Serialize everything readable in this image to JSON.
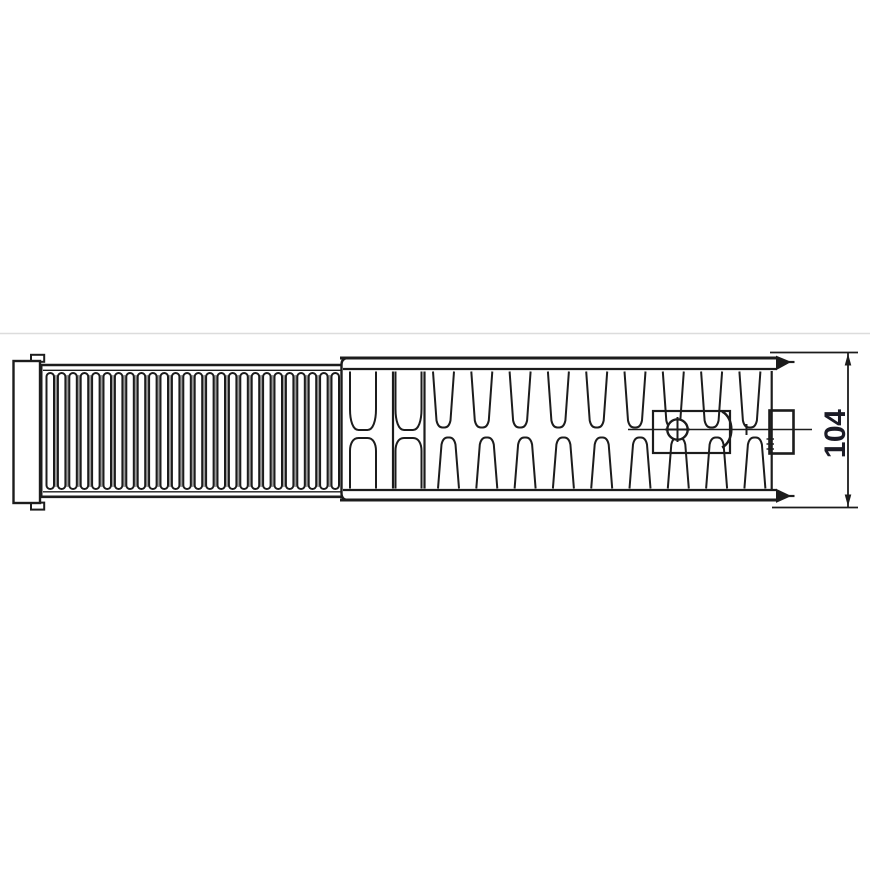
{
  "drawing": {
    "kind": "radiator-top-view-technical-drawing",
    "dimension": {
      "value": "104"
    },
    "grille": {
      "slot_count": 26,
      "shade_strip_count": 25
    },
    "convector": {
      "hourglass_fin_count": 2,
      "upper_fin_count": 9,
      "lower_fin_count": 9
    },
    "icons": {
      "valve": "circle-cross-valve-icon",
      "dimension_arrows": "dimension-arrowhead-icon"
    },
    "colors": {
      "line": "#1c1c1c",
      "shading": "#9b9b9b",
      "dimension_text": "#1b1b26",
      "frame_line": "#dcdcdc",
      "background": "#ffffff"
    }
  }
}
